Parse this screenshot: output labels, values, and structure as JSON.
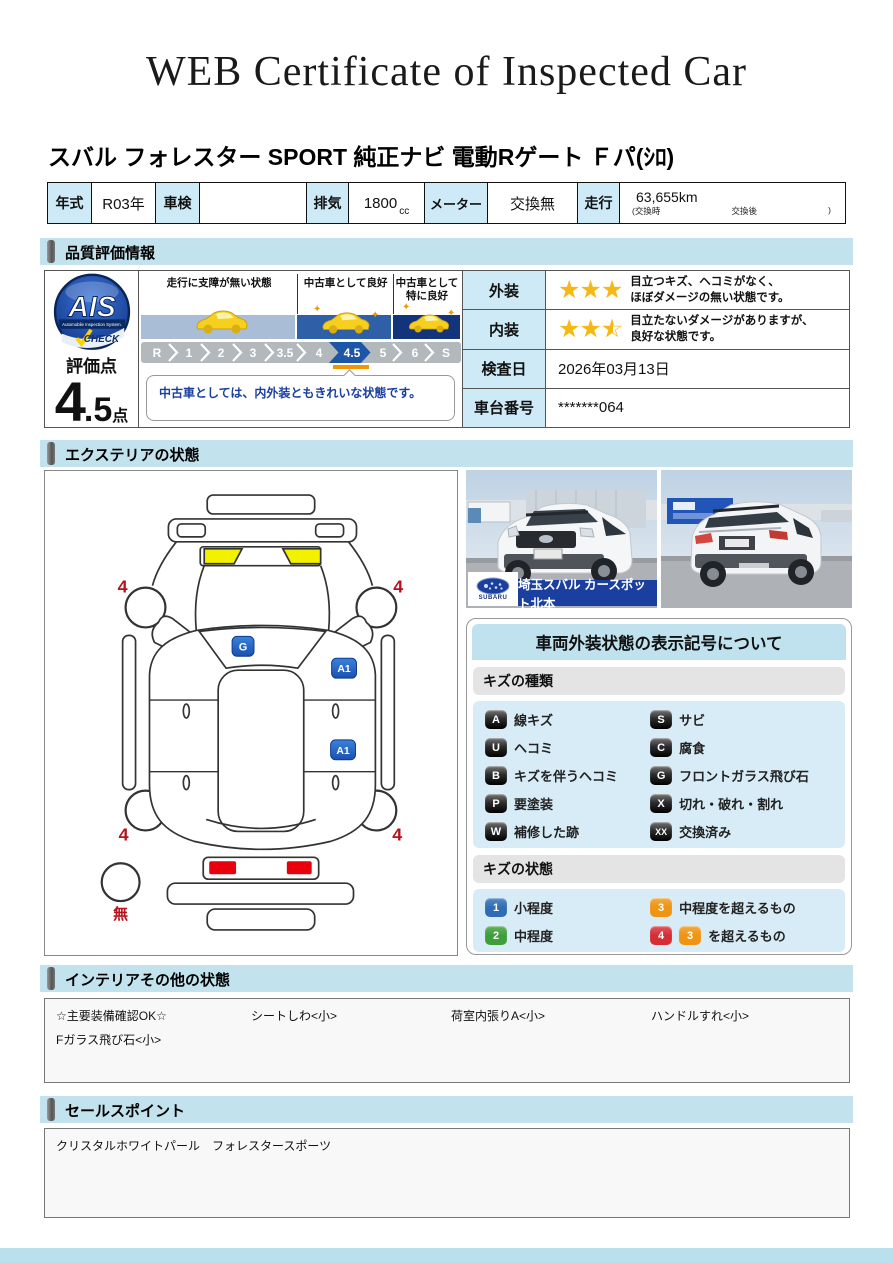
{
  "page_title": "WEB Certificate of Inspected Car",
  "car_title": "スバル フォレスター SPORT 純正ナビ 電動Rゲート Ｆパ(ｼﾛ)",
  "spec": {
    "year_label": "年式",
    "year": "R03年",
    "inspection_label": "車検",
    "inspection": "",
    "displacement_label": "排気",
    "displacement": "1800",
    "displacement_unit": "cc",
    "meter_label": "メーター",
    "meter": "交換無",
    "mileage_label": "走行",
    "mileage": "63,655km",
    "mileage_note_open": "(交換時",
    "mileage_note_mid": "交換後",
    "mileage_note_close": ")"
  },
  "section_headers": {
    "quality": "品質評価情報",
    "exterior": "エクステリアの状態",
    "interior": "インテリアその他の状態",
    "sales": "セールスポイント"
  },
  "quality": {
    "logo": {
      "name": "AIS",
      "subtitle": "Automobile Inspection System.",
      "check": "CHECK"
    },
    "score_label": "評価点",
    "score_int": "4",
    "score_dec": ".5",
    "score_unit": "点",
    "zones": [
      "走行に支障が無い状態",
      "中古車として良好",
      "中古車として特に良好"
    ],
    "scale": [
      "R",
      "1",
      "2",
      "3",
      "3.5",
      "4",
      "4.5",
      "5",
      "6",
      "S"
    ],
    "selected_grade": "4.5",
    "comment": "中古車としては、内外装ともきれいな状態です。",
    "rows": {
      "exterior": {
        "label": "外装",
        "stars": 3,
        "text1": "目立つキズ、ヘコミがなく、",
        "text2": "ほぼダメージの無い状態です。"
      },
      "interior": {
        "label": "内装",
        "stars": 2.5,
        "text1": "目立たないダメージがありますが、",
        "text2": "良好な状態です。"
      },
      "date": {
        "label": "検査日",
        "value": "2026年03月13日"
      },
      "vin": {
        "label": "車台番号",
        "value": "*******064"
      }
    }
  },
  "photos": {
    "dealer_caption": "埼玉スバル カースポット北本",
    "logo_text": "SUBARU"
  },
  "diagram": {
    "wheel_marks": [
      "4",
      "4",
      "4",
      "4"
    ],
    "spare_mark": "無",
    "glass_mark": "G",
    "side_marks": [
      "A1",
      "A1"
    ]
  },
  "legend": {
    "title": "車両外装状態の表示記号について",
    "kinds_header": "キズの種類",
    "kinds": [
      {
        "code": "A",
        "label": "線キズ"
      },
      {
        "code": "S",
        "label": "サビ"
      },
      {
        "code": "U",
        "label": "ヘコミ"
      },
      {
        "code": "C",
        "label": "腐食"
      },
      {
        "code": "B",
        "label": "キズを伴うヘコミ"
      },
      {
        "code": "G",
        "label": "フロントガラス飛び石"
      },
      {
        "code": "P",
        "label": "要塗装"
      },
      {
        "code": "X",
        "label": "切れ・破れ・割れ"
      },
      {
        "code": "W",
        "label": "補修した跡"
      },
      {
        "code": "XX",
        "label": "交換済み"
      }
    ],
    "states_header": "キズの状態",
    "states": [
      {
        "code": "1",
        "label": "小程度",
        "color": "#2e6db4"
      },
      {
        "code": "3",
        "label": "中程度を超えるもの",
        "color": "#ef9413"
      },
      {
        "code": "2",
        "label": "中程度",
        "color": "#3e9e3a"
      },
      {
        "code": "4",
        "extra_code": "3",
        "label": "を超えるもの",
        "color": "#d62e35"
      }
    ]
  },
  "interior_section": {
    "row1": [
      "☆主要装備確認OK☆",
      "シートしわ<小>",
      "荷室内張りA<小>",
      "ハンドルすれ<小>"
    ],
    "row2": [
      "Fガラス飛び石<小>"
    ]
  },
  "sales_point": "クリスタルホワイトパール　フォレスタースポーツ",
  "colors": {
    "header_bg": "#c2e3ee",
    "label_cell_bg": "#cdeaf6",
    "star": "#f5b814",
    "accent_blue": "#1d55a7",
    "marker_orange": "#f29600",
    "legend_item_bg": "#d8ecf7"
  }
}
